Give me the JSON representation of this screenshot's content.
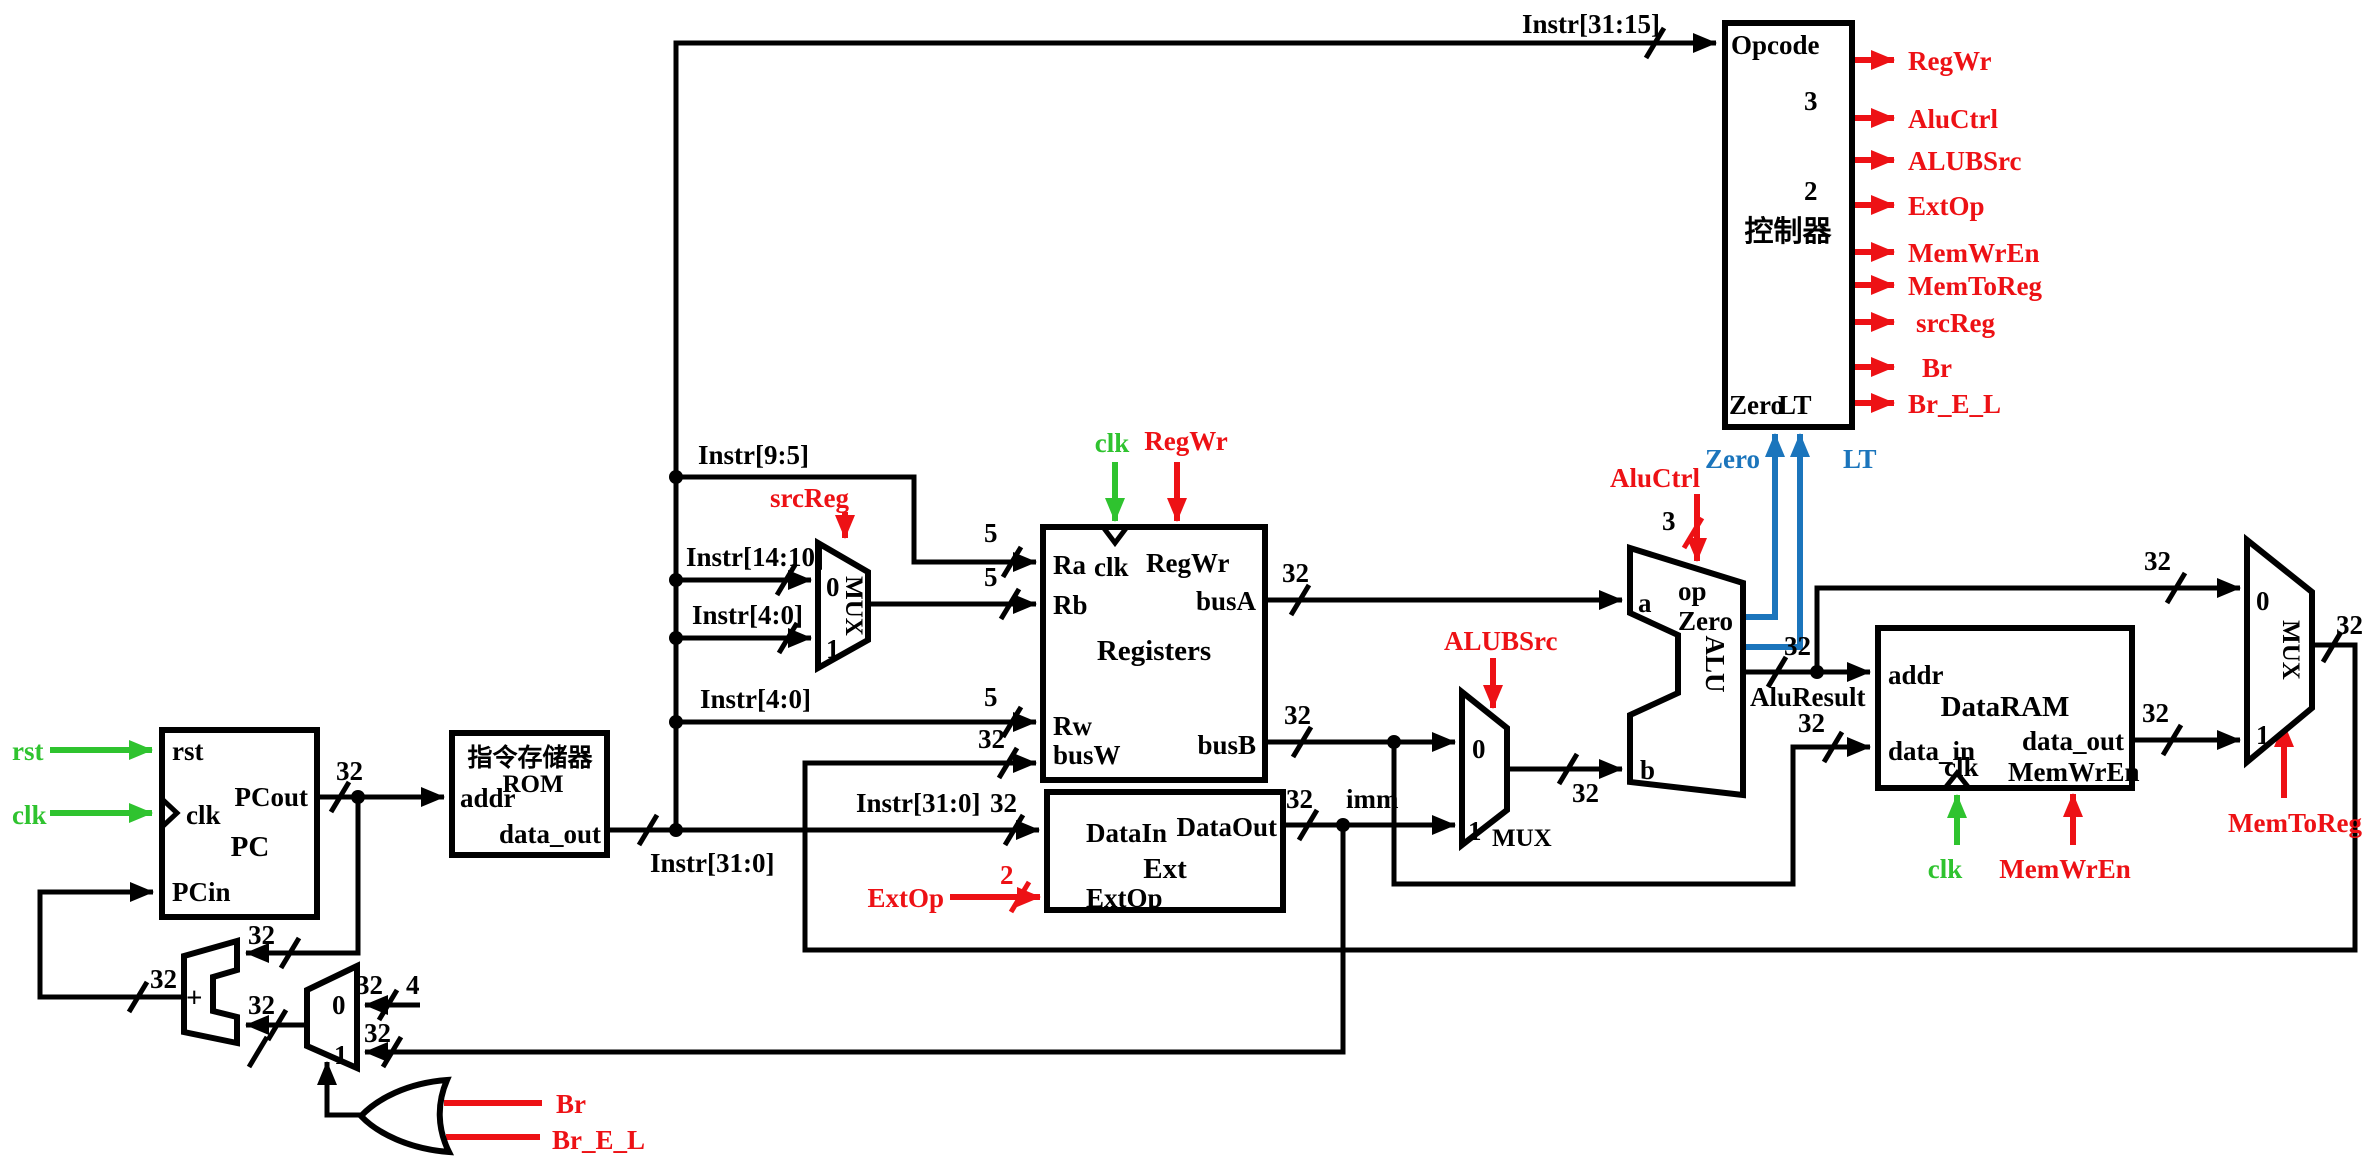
{
  "colors": {
    "wire_black": "#000000",
    "control_red": "#ed1115",
    "clock_green": "#2fc32f",
    "flag_blue": "#1b75bc"
  },
  "widths": {
    "b32": "32",
    "b5": "5",
    "b4": "4",
    "b3": "3",
    "b2": "2"
  },
  "mux": {
    "zero": "0",
    "one": "1",
    "label": "MUX"
  },
  "adder": {
    "plus": "+"
  },
  "wires": {
    "instr_31_15": "Instr[31:15]",
    "instr_9_5": "Instr[9:5]",
    "instr_14_10": "Instr[14:10]",
    "instr_4_0": "Instr[4:0]",
    "instr_31_0": "Instr[31:0]",
    "imm": "imm",
    "alu_result": "AluResult"
  },
  "signals": {
    "rst": "rst",
    "clk": "clk",
    "zero": "Zero",
    "lt": "LT",
    "br": "Br",
    "br_e_l": "Br_E_L",
    "reg_wr": "RegWr",
    "alu_ctrl": "AluCtrl",
    "alubsrc": "ALUBSrc",
    "ext_op": "ExtOp",
    "mem_wr_en": "MemWrEn",
    "mem_to_reg": "MemToReg",
    "src_reg": "srcReg"
  },
  "blocks": {
    "pc": {
      "title": "PC",
      "rst": "rst",
      "clk": "clk",
      "pcout": "PCout",
      "pcin": "PCin"
    },
    "rom": {
      "title": "指令存储器",
      "subtitle": "ROM",
      "addr": "addr",
      "data_out": "data_out"
    },
    "registers": {
      "title": "Registers",
      "ra": "Ra",
      "rb": "Rb",
      "rw": "Rw",
      "busw": "busW",
      "busa": "busA",
      "busb": "busB",
      "clk": "clk",
      "reg_wr": "RegWr"
    },
    "ext": {
      "title": "Ext",
      "data_in": "DataIn",
      "data_out": "DataOut",
      "ext_op": "ExtOp"
    },
    "alu": {
      "title": "ALU",
      "a": "a",
      "b": "b",
      "op": "op",
      "zero": "Zero"
    },
    "dataram": {
      "title": "DataRAM",
      "addr": "addr",
      "data_in": "data_in",
      "data_out": "data_out",
      "clk": "clk",
      "mem_wr_en": "MemWrEn"
    },
    "controller": {
      "title": "控制器",
      "opcode": "Opcode",
      "zero": "Zero",
      "lt": "LT",
      "outputs": [
        {
          "label": "RegWr"
        },
        {
          "label": "AluCtrl",
          "width": "3"
        },
        {
          "label": "ALUBSrc"
        },
        {
          "label": "ExtOp",
          "width": "2"
        },
        {
          "label": "MemWrEn"
        },
        {
          "label": "MemToReg"
        },
        {
          "label": "srcReg"
        },
        {
          "label": "Br"
        },
        {
          "label": "Br_E_L"
        }
      ]
    }
  }
}
